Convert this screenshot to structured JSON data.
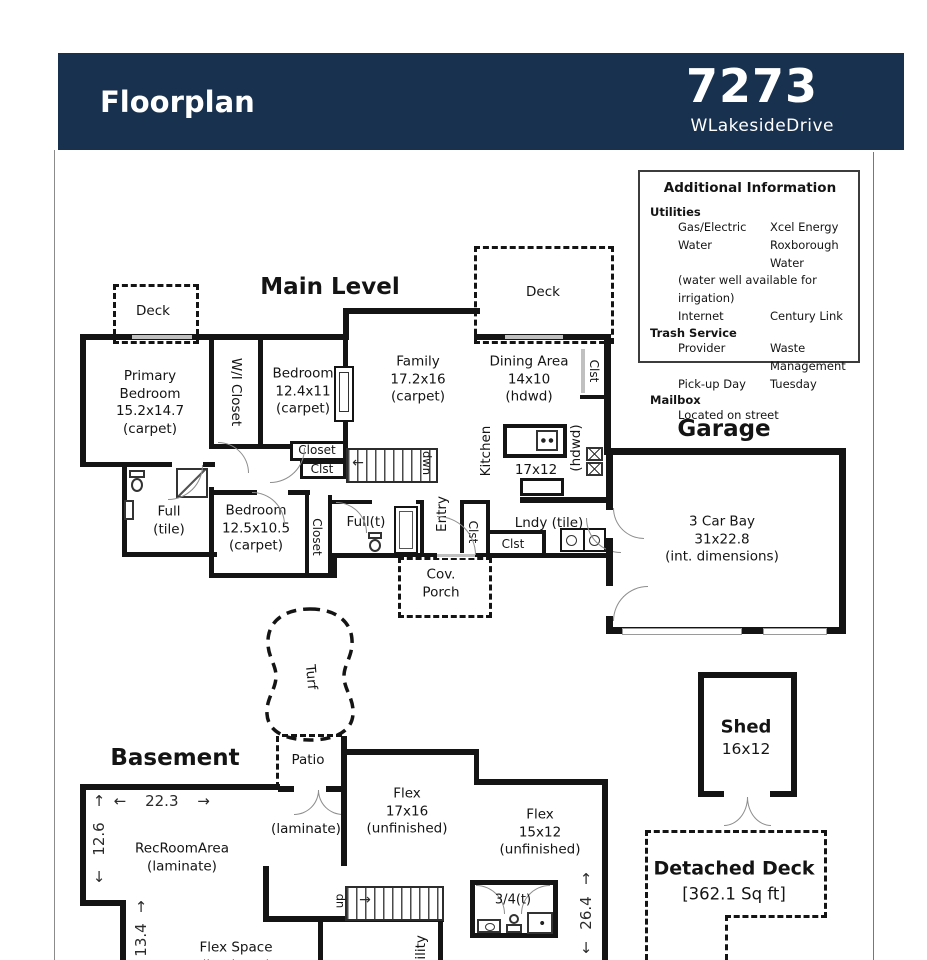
{
  "header": {
    "title": "Floorplan",
    "address_number": "7273",
    "address_street": "WLakesideDrive"
  },
  "info_box": {
    "title": "Additional Information",
    "utilities": {
      "heading": "Utilities",
      "rows": [
        {
          "label": "Gas/Electric",
          "value": "Xcel Energy"
        },
        {
          "label": "Water",
          "value": "Roxborough Water"
        }
      ],
      "note": "(water well available for irrigation)",
      "rows2": [
        {
          "label": "Internet",
          "value": "Century Link"
        }
      ]
    },
    "trash": {
      "heading": "Trash Service",
      "rows": [
        {
          "label": "Provider",
          "value": "Waste Management"
        },
        {
          "label": "Pick-up Day",
          "value": "Tuesday"
        }
      ]
    },
    "mailbox": {
      "heading": "Mailbox",
      "note": "Located on street"
    }
  },
  "main_level": {
    "heading": "Main Level",
    "deck_left": "Deck",
    "deck_right": "Deck",
    "primary_bedroom": "Primary\nBedroom\n15.2x14.7\n(carpet)",
    "wi_closet": "W/I Closet",
    "bedroom2": "Bedroom\n12.4x11\n(carpet)",
    "closet": "Closet",
    "clst_small": "Clst",
    "family": "Family\n17.2x16\n(carpet)",
    "dining": "Dining Area\n14x10\n(hdwd)",
    "clst_dining": "Clst",
    "kitchen": "Kitchen",
    "kitchen_size": "17x12",
    "hdwd": "(hdwd)",
    "dwn": "dwn",
    "full_tile": "Full\n(tile)",
    "bedroom3": "Bedroom\n12.5x10.5\n(carpet)",
    "closet3": "Closet",
    "full_t": "Full(t)",
    "entry": "Entry",
    "clst_entry": "Clst",
    "clst_hall": "Clst",
    "lndy": "Lndy (tile)",
    "cov_porch": "Cov.\nPorch"
  },
  "garage": {
    "heading": "Garage",
    "label": "3 Car Bay\n31x22.8\n(int. dimensions)"
  },
  "basement": {
    "heading": "Basement",
    "turf": "Turf",
    "patio": "Patio",
    "laminate": "(laminate)",
    "rec_room": "RecRoomArea\n(laminate)",
    "flex1": "Flex\n17x16\n(unfinished)",
    "flex2": "Flex\n15x12\n(unfinished)",
    "flex_space": "Flex Space\n(laminate)",
    "bath": "3/4(t)",
    "up": "up",
    "utility": "Utility",
    "dim_width": "22.3",
    "dim_left": "12.6",
    "dim_left2": "13.4",
    "dim_right": "26.4"
  },
  "outbuildings": {
    "shed_name": "Shed",
    "shed_size": "16x12",
    "deck_name": "Detached Deck",
    "deck_size": "[362.1 Sq ft]"
  },
  "glyphs": {
    "arrow_up": "↑",
    "arrow_down": "↓",
    "arrow_left": "←",
    "arrow_right": "→"
  }
}
